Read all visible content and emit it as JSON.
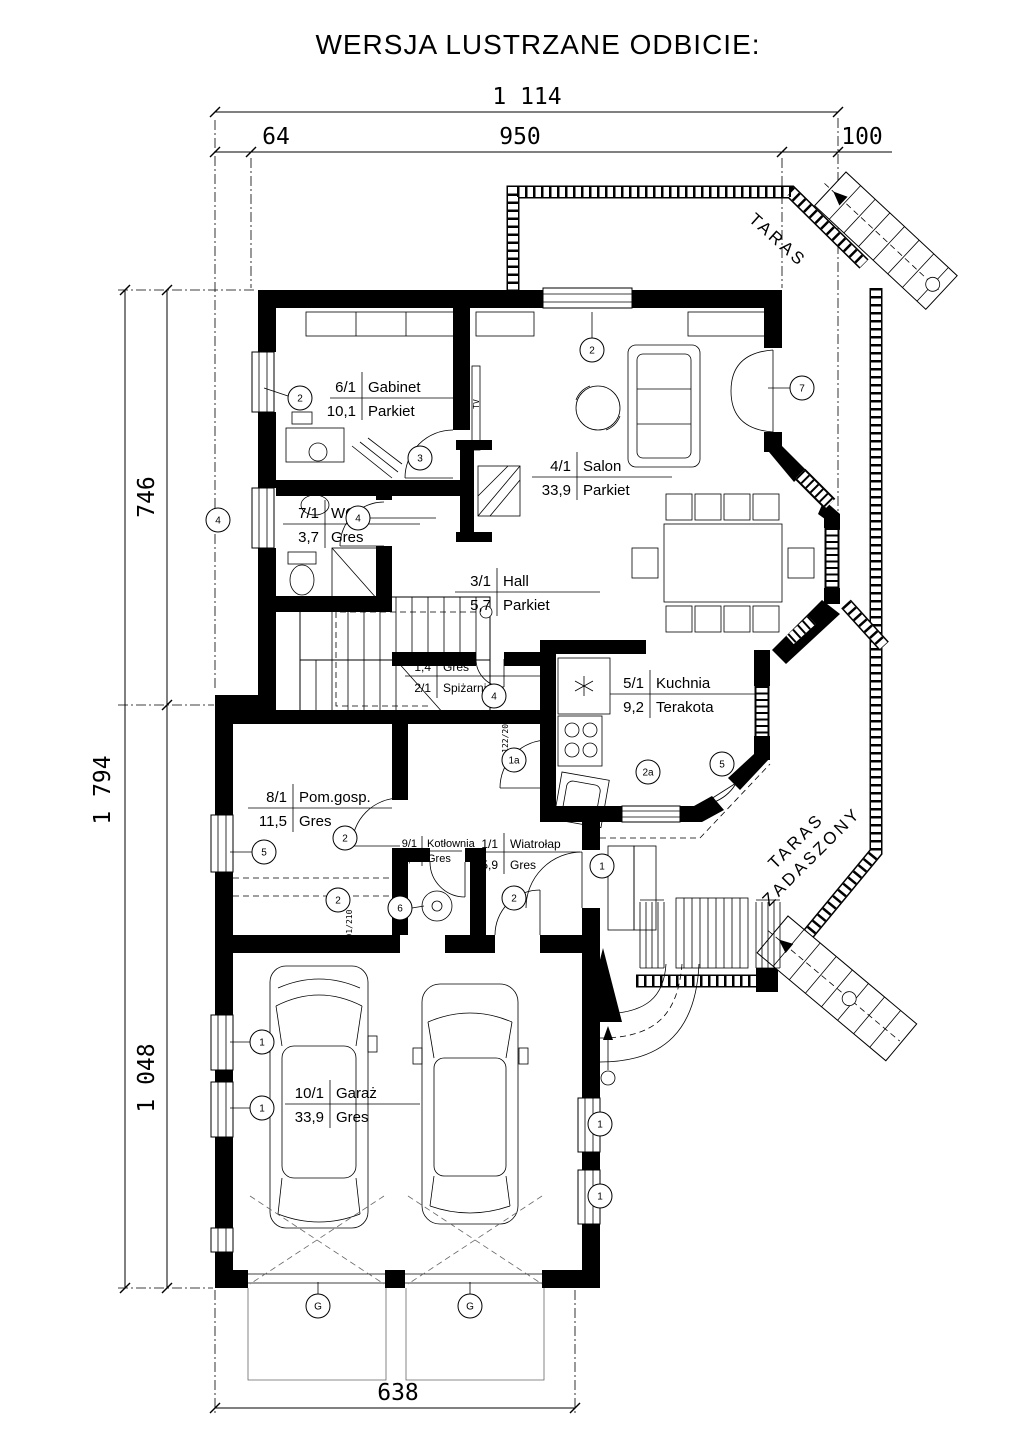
{
  "title": "WERSJA LUSTRZANE ODBICIE:",
  "dimensions": {
    "top_total": "1 114",
    "top_seg_left": "64",
    "top_seg_mid": "950",
    "top_seg_right": "100",
    "left_total": "1 794",
    "left_upper": "746",
    "left_lower": "1 048",
    "bottom_width": "638"
  },
  "rooms": [
    {
      "num": "6/1",
      "name": "Gabinet",
      "area": "10,1",
      "floor": "Parkiet"
    },
    {
      "num": "7/1",
      "name": "WC",
      "area": "3,7",
      "floor": "Gres"
    },
    {
      "num": "4/1",
      "name": "Salon",
      "area": "33,9",
      "floor": "Parkiet"
    },
    {
      "num": "3/1",
      "name": "Hall",
      "area": "5,7",
      "floor": "Parkiet"
    },
    {
      "num": "2/1",
      "name": "Spiżarnia",
      "area": "1,4",
      "floor": "Gres"
    },
    {
      "num": "5/1",
      "name": "Kuchnia",
      "area": "9,2",
      "floor": "Terakota"
    },
    {
      "num": "8/1",
      "name": "Pom.gosp.",
      "area": "11,5",
      "floor": "Gres"
    },
    {
      "num": "9/1",
      "name": "Kotłownia",
      "area": "2,9",
      "floor": "Gres"
    },
    {
      "num": "1/1",
      "name": "Wiatrołap",
      "area": "5,9",
      "floor": "Gres"
    },
    {
      "num": "10/1",
      "name": "Garaż",
      "area": "33,9",
      "floor": "Gres"
    }
  ],
  "outdoor": {
    "taras": "TARAS",
    "zadaszony_line1": "TARAS",
    "zadaszony_line2": "ZADASZONY"
  },
  "annotations": {
    "tv": "TV",
    "door_size_1": "122/207",
    "door_size_2": "91/210"
  },
  "markers": [
    "2",
    "3",
    "4",
    "4",
    "2",
    "7",
    "4",
    "1a",
    "2a",
    "5",
    "5",
    "2",
    "2",
    "6",
    "2",
    "1",
    "1",
    "1",
    "1",
    "1",
    "G",
    "G"
  ],
  "colors": {
    "ink": "#000000",
    "paper": "#ffffff"
  }
}
